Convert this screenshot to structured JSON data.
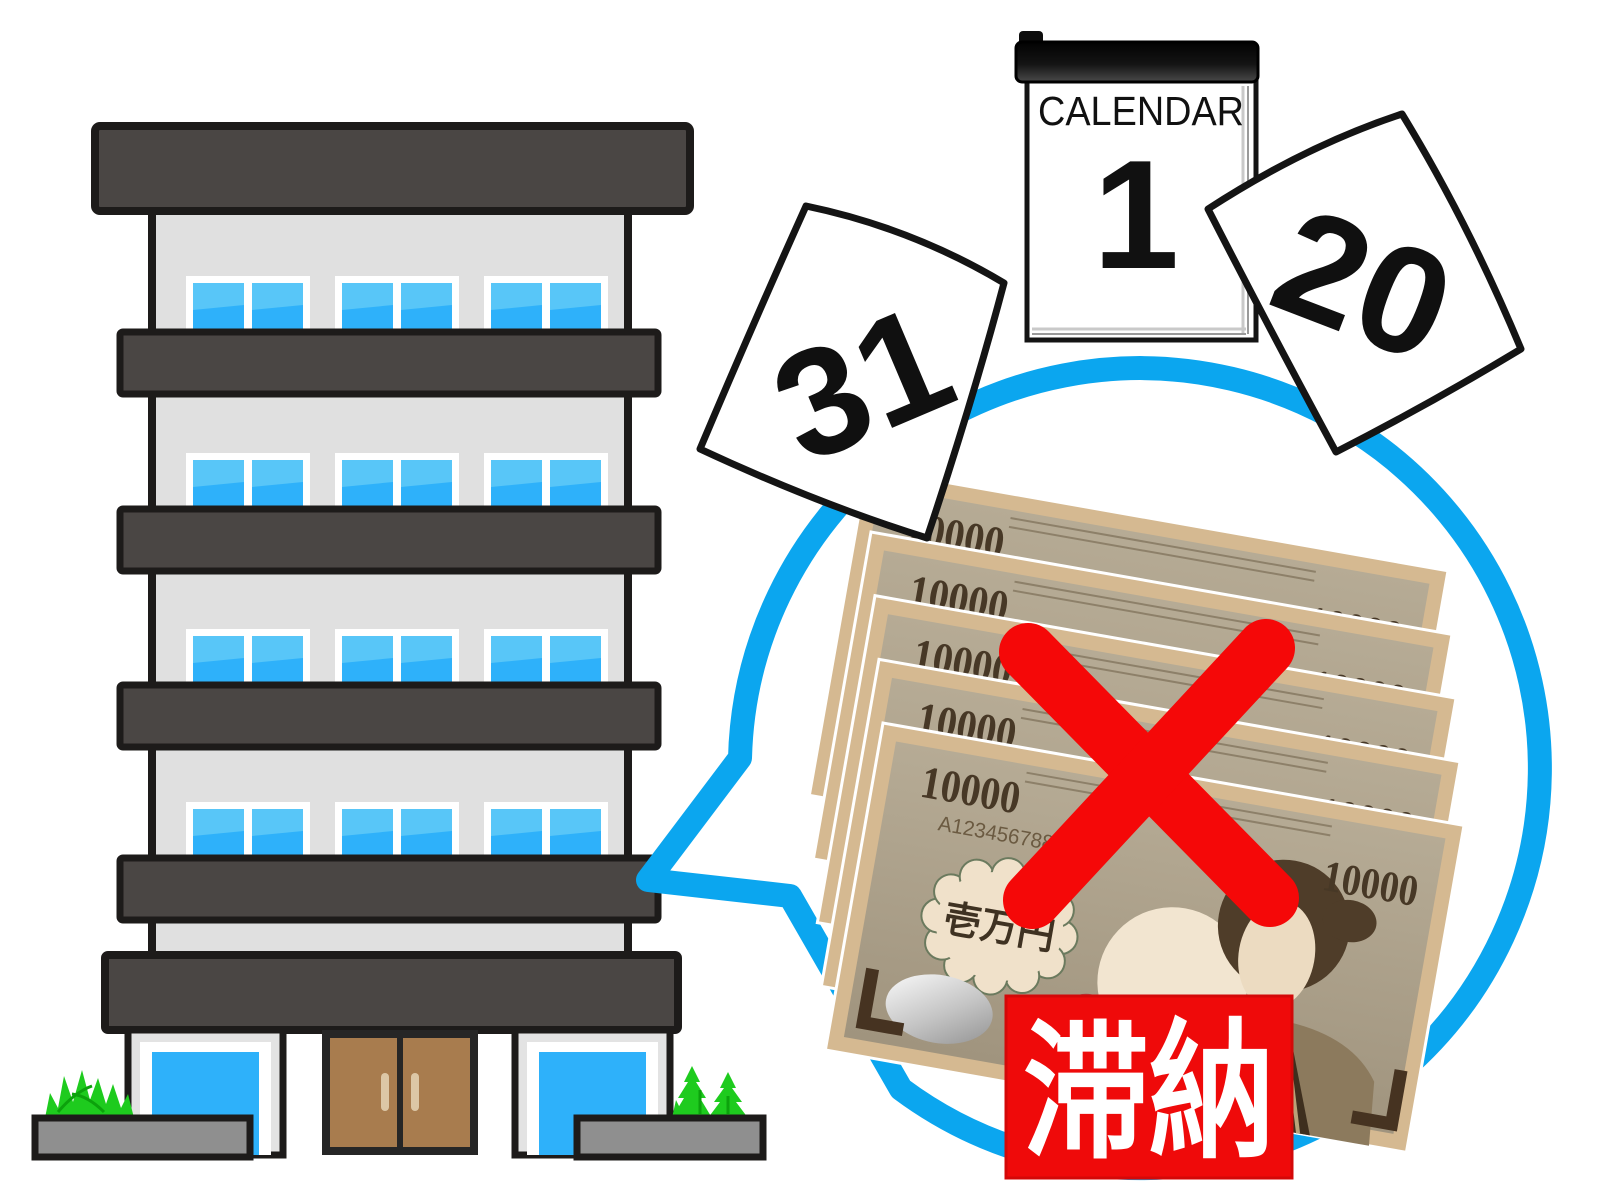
{
  "illustration": {
    "description": "apartment building with speech bubble showing unpaid rent (crossed-out 10000-yen bills) and flying calendar pages",
    "calendar": {
      "title": "CALENDAR",
      "day": "1"
    },
    "torn_pages": [
      {
        "number": "31"
      },
      {
        "number": "20"
      }
    ],
    "bills": {
      "count": 5,
      "denomination": "10000",
      "serial": "A1234567889",
      "label": "壱万円"
    },
    "stamp": {
      "text": "滞納"
    },
    "colors": {
      "outline": "#1d1b1a",
      "band_dark_gray": "#4a4644",
      "wall_gray": "#e0e0e0",
      "window_blue": "#2eb1fa",
      "window_blue_light": "#58c6f8",
      "door_brown": "#a87c4e",
      "door_handle": "#dcc7a6",
      "planter_gray": "#8f8f8f",
      "bush_green": "#1ecb1e",
      "bubble_blue": "#0ba6ef",
      "alert_red": "#f50808",
      "bill_border_tan": "#d5b991",
      "bill_inner": "#aca08a",
      "bill_ink_brown": "#473826",
      "cloud_cream": "#f0e1ca",
      "seal_red": "#b36363",
      "hair_brown": "#4f3d29"
    }
  }
}
